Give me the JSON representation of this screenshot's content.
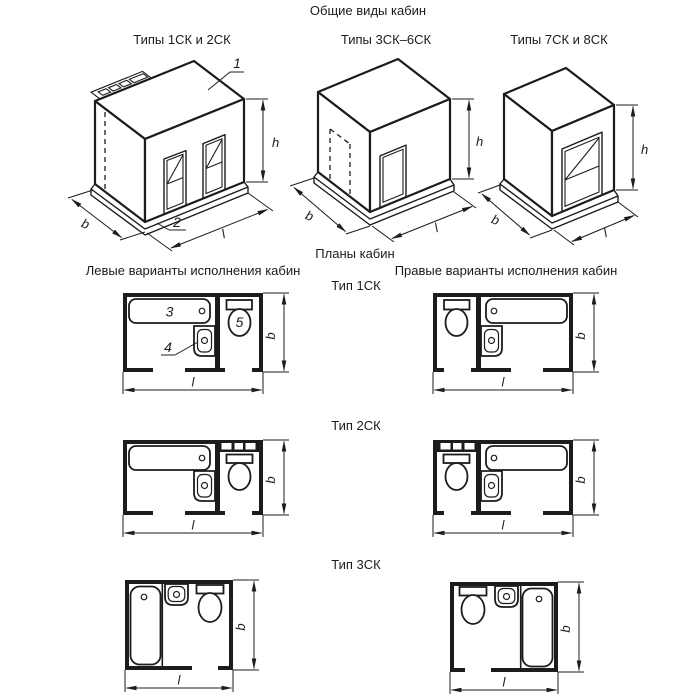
{
  "page": {
    "title": "Общие виды кабин",
    "plans_title": "Планы кабин",
    "left_variant_header": "Левые варианты исполнения кабин",
    "right_variant_header": "Правые варианты исполнения кабин"
  },
  "views": [
    {
      "caption": "Типы 1СК и 2СК"
    },
    {
      "caption": "Типы 3СК–6СК"
    },
    {
      "caption": "Типы 7СК и 8СК"
    }
  ],
  "plan_rows": [
    {
      "label": "Тип 1СК"
    },
    {
      "label": "Тип 2СК"
    },
    {
      "label": "Тип 3СК"
    }
  ],
  "dim_labels": {
    "height": "h",
    "depth": "b",
    "length": "l"
  },
  "callouts": {
    "ceiling_panel": "1",
    "base_panel": "2",
    "bath": "3",
    "washbasin": "4",
    "toilet": "5"
  },
  "colors": {
    "line": "#1c1c1c",
    "background": "#ffffff"
  }
}
